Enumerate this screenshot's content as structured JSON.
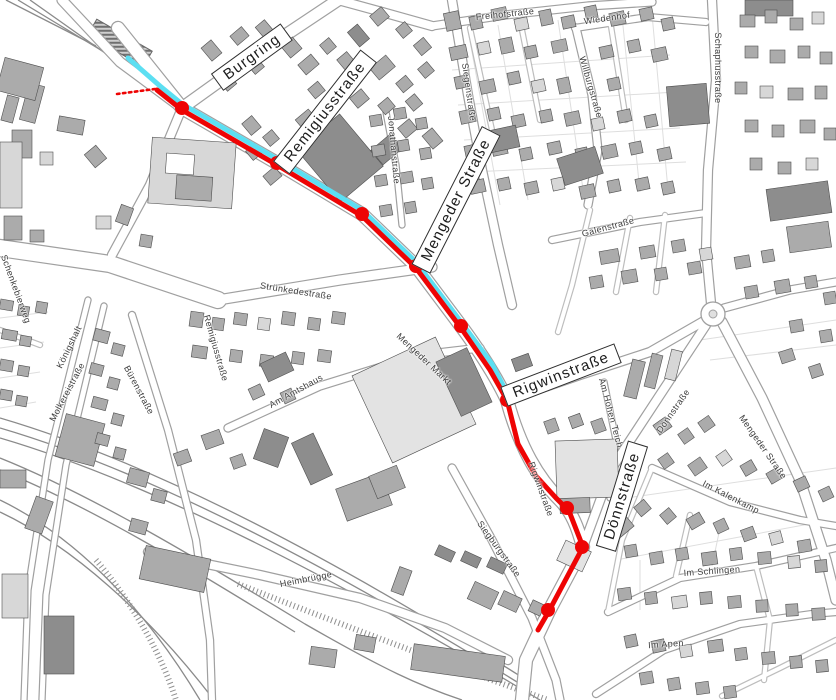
{
  "map_title": "Street map with highlighted tram route",
  "colors": {
    "background": "#ffffff",
    "route_red": "#ee0404",
    "route_cyan": "#5cdff2",
    "road_casing": "#a0a0a0",
    "building_light": "#d7d7d7",
    "building_mid": "#ababab",
    "building_dark": "#8d8d8d",
    "building_pale": "#e3e3e3",
    "rail_gray": "#8a8a8a"
  },
  "route": {
    "description": "red route line with stop dots and parallel cyan line, plus dashed red tail at north end",
    "red_line_points": [
      [
        157,
        90
      ],
      [
        182,
        110
      ],
      [
        277,
        165
      ],
      [
        362,
        216
      ],
      [
        416,
        268
      ],
      [
        461,
        328
      ],
      [
        490,
        370
      ],
      [
        507,
        400
      ],
      [
        518,
        444
      ],
      [
        536,
        476
      ],
      [
        556,
        498
      ],
      [
        569,
        511
      ],
      [
        583,
        547
      ],
      [
        549,
        611
      ],
      [
        538,
        630
      ]
    ],
    "cyan_line_points": [
      [
        128,
        58
      ],
      [
        160,
        86
      ],
      [
        182,
        104
      ],
      [
        277,
        159
      ],
      [
        362,
        210
      ],
      [
        416,
        262
      ],
      [
        461,
        322
      ],
      [
        492,
        364
      ],
      [
        509,
        397
      ]
    ],
    "dashed_tail_points": [
      [
        117,
        94
      ],
      [
        155,
        89
      ]
    ],
    "stops": [
      [
        182,
        108
      ],
      [
        277,
        163
      ],
      [
        362,
        214
      ],
      [
        416,
        266
      ],
      [
        461,
        326
      ],
      [
        507,
        400
      ],
      [
        567,
        508
      ],
      [
        582,
        547
      ],
      [
        548,
        610
      ]
    ],
    "stop_radius": 7
  },
  "street_labels": [
    {
      "text": "Burgring",
      "x": 252,
      "y": 57,
      "rot": -36,
      "boxed": true
    },
    {
      "text": "Remigiusstraße",
      "x": 325,
      "y": 112,
      "rot": -52,
      "boxed": true
    },
    {
      "text": "Mengeder Straße",
      "x": 456,
      "y": 200,
      "rot": -63,
      "boxed": true
    },
    {
      "text": "Rigwinstraße",
      "x": 561,
      "y": 375,
      "rot": -21,
      "boxed": true
    },
    {
      "text": "Dönnstraße",
      "x": 622,
      "y": 496,
      "rot": -73,
      "boxed": true
    },
    {
      "text": "Freihofstraße",
      "x": 505,
      "y": 14,
      "rot": -6,
      "boxed": false
    },
    {
      "text": "Wiedenhof",
      "x": 607,
      "y": 18,
      "rot": -8,
      "boxed": false
    },
    {
      "text": "Siegenstraße",
      "x": 469,
      "y": 92,
      "rot": 82,
      "boxed": false
    },
    {
      "text": "Willburgstraße",
      "x": 591,
      "y": 87,
      "rot": 74,
      "boxed": false
    },
    {
      "text": "Schaphusstraße",
      "x": 718,
      "y": 68,
      "rot": 90,
      "boxed": false
    },
    {
      "text": "Jonathanstraße",
      "x": 394,
      "y": 150,
      "rot": 85,
      "boxed": false
    },
    {
      "text": "Galenstraße",
      "x": 608,
      "y": 227,
      "rot": -15,
      "boxed": false
    },
    {
      "text": "Strünkedestraße",
      "x": 296,
      "y": 291,
      "rot": 9,
      "boxed": false
    },
    {
      "text": "Remigiusstraße",
      "x": 216,
      "y": 348,
      "rot": 74,
      "boxed": false
    },
    {
      "text": "Am Amtshaus",
      "x": 296,
      "y": 391,
      "rot": -29,
      "boxed": false
    },
    {
      "text": "Schenkebierweg",
      "x": 16,
      "y": 289,
      "rot": 70,
      "boxed": false
    },
    {
      "text": "Königshalt",
      "x": 69,
      "y": 347,
      "rot": -64,
      "boxed": false
    },
    {
      "text": "Molkereistraße",
      "x": 67,
      "y": 392,
      "rot": -62,
      "boxed": false
    },
    {
      "text": "Bürenstraße",
      "x": 139,
      "y": 390,
      "rot": 62,
      "boxed": false
    },
    {
      "text": "Mengeder Markt",
      "x": 424,
      "y": 359,
      "rot": 43,
      "boxed": false
    },
    {
      "text": "Am Hohen Teich",
      "x": 611,
      "y": 413,
      "rot": 75,
      "boxed": false
    },
    {
      "text": "Dönnstraße",
      "x": 673,
      "y": 411,
      "rot": -55,
      "boxed": false
    },
    {
      "text": "Mengeder Straße",
      "x": 763,
      "y": 447,
      "rot": 55,
      "boxed": false
    },
    {
      "text": "Im Kalenkamp",
      "x": 731,
      "y": 497,
      "rot": 27,
      "boxed": false
    },
    {
      "text": "Rigwinstraße",
      "x": 541,
      "y": 489,
      "rot": 70,
      "boxed": false
    },
    {
      "text": "Siegburgstraße",
      "x": 499,
      "y": 549,
      "rot": 54,
      "boxed": false
    },
    {
      "text": "Heimbrügge",
      "x": 306,
      "y": 579,
      "rot": -11,
      "boxed": false
    },
    {
      "text": "Im Schlingen",
      "x": 712,
      "y": 571,
      "rot": -4,
      "boxed": false
    },
    {
      "text": "Im Apen",
      "x": 666,
      "y": 644,
      "rot": -4,
      "boxed": false
    }
  ]
}
